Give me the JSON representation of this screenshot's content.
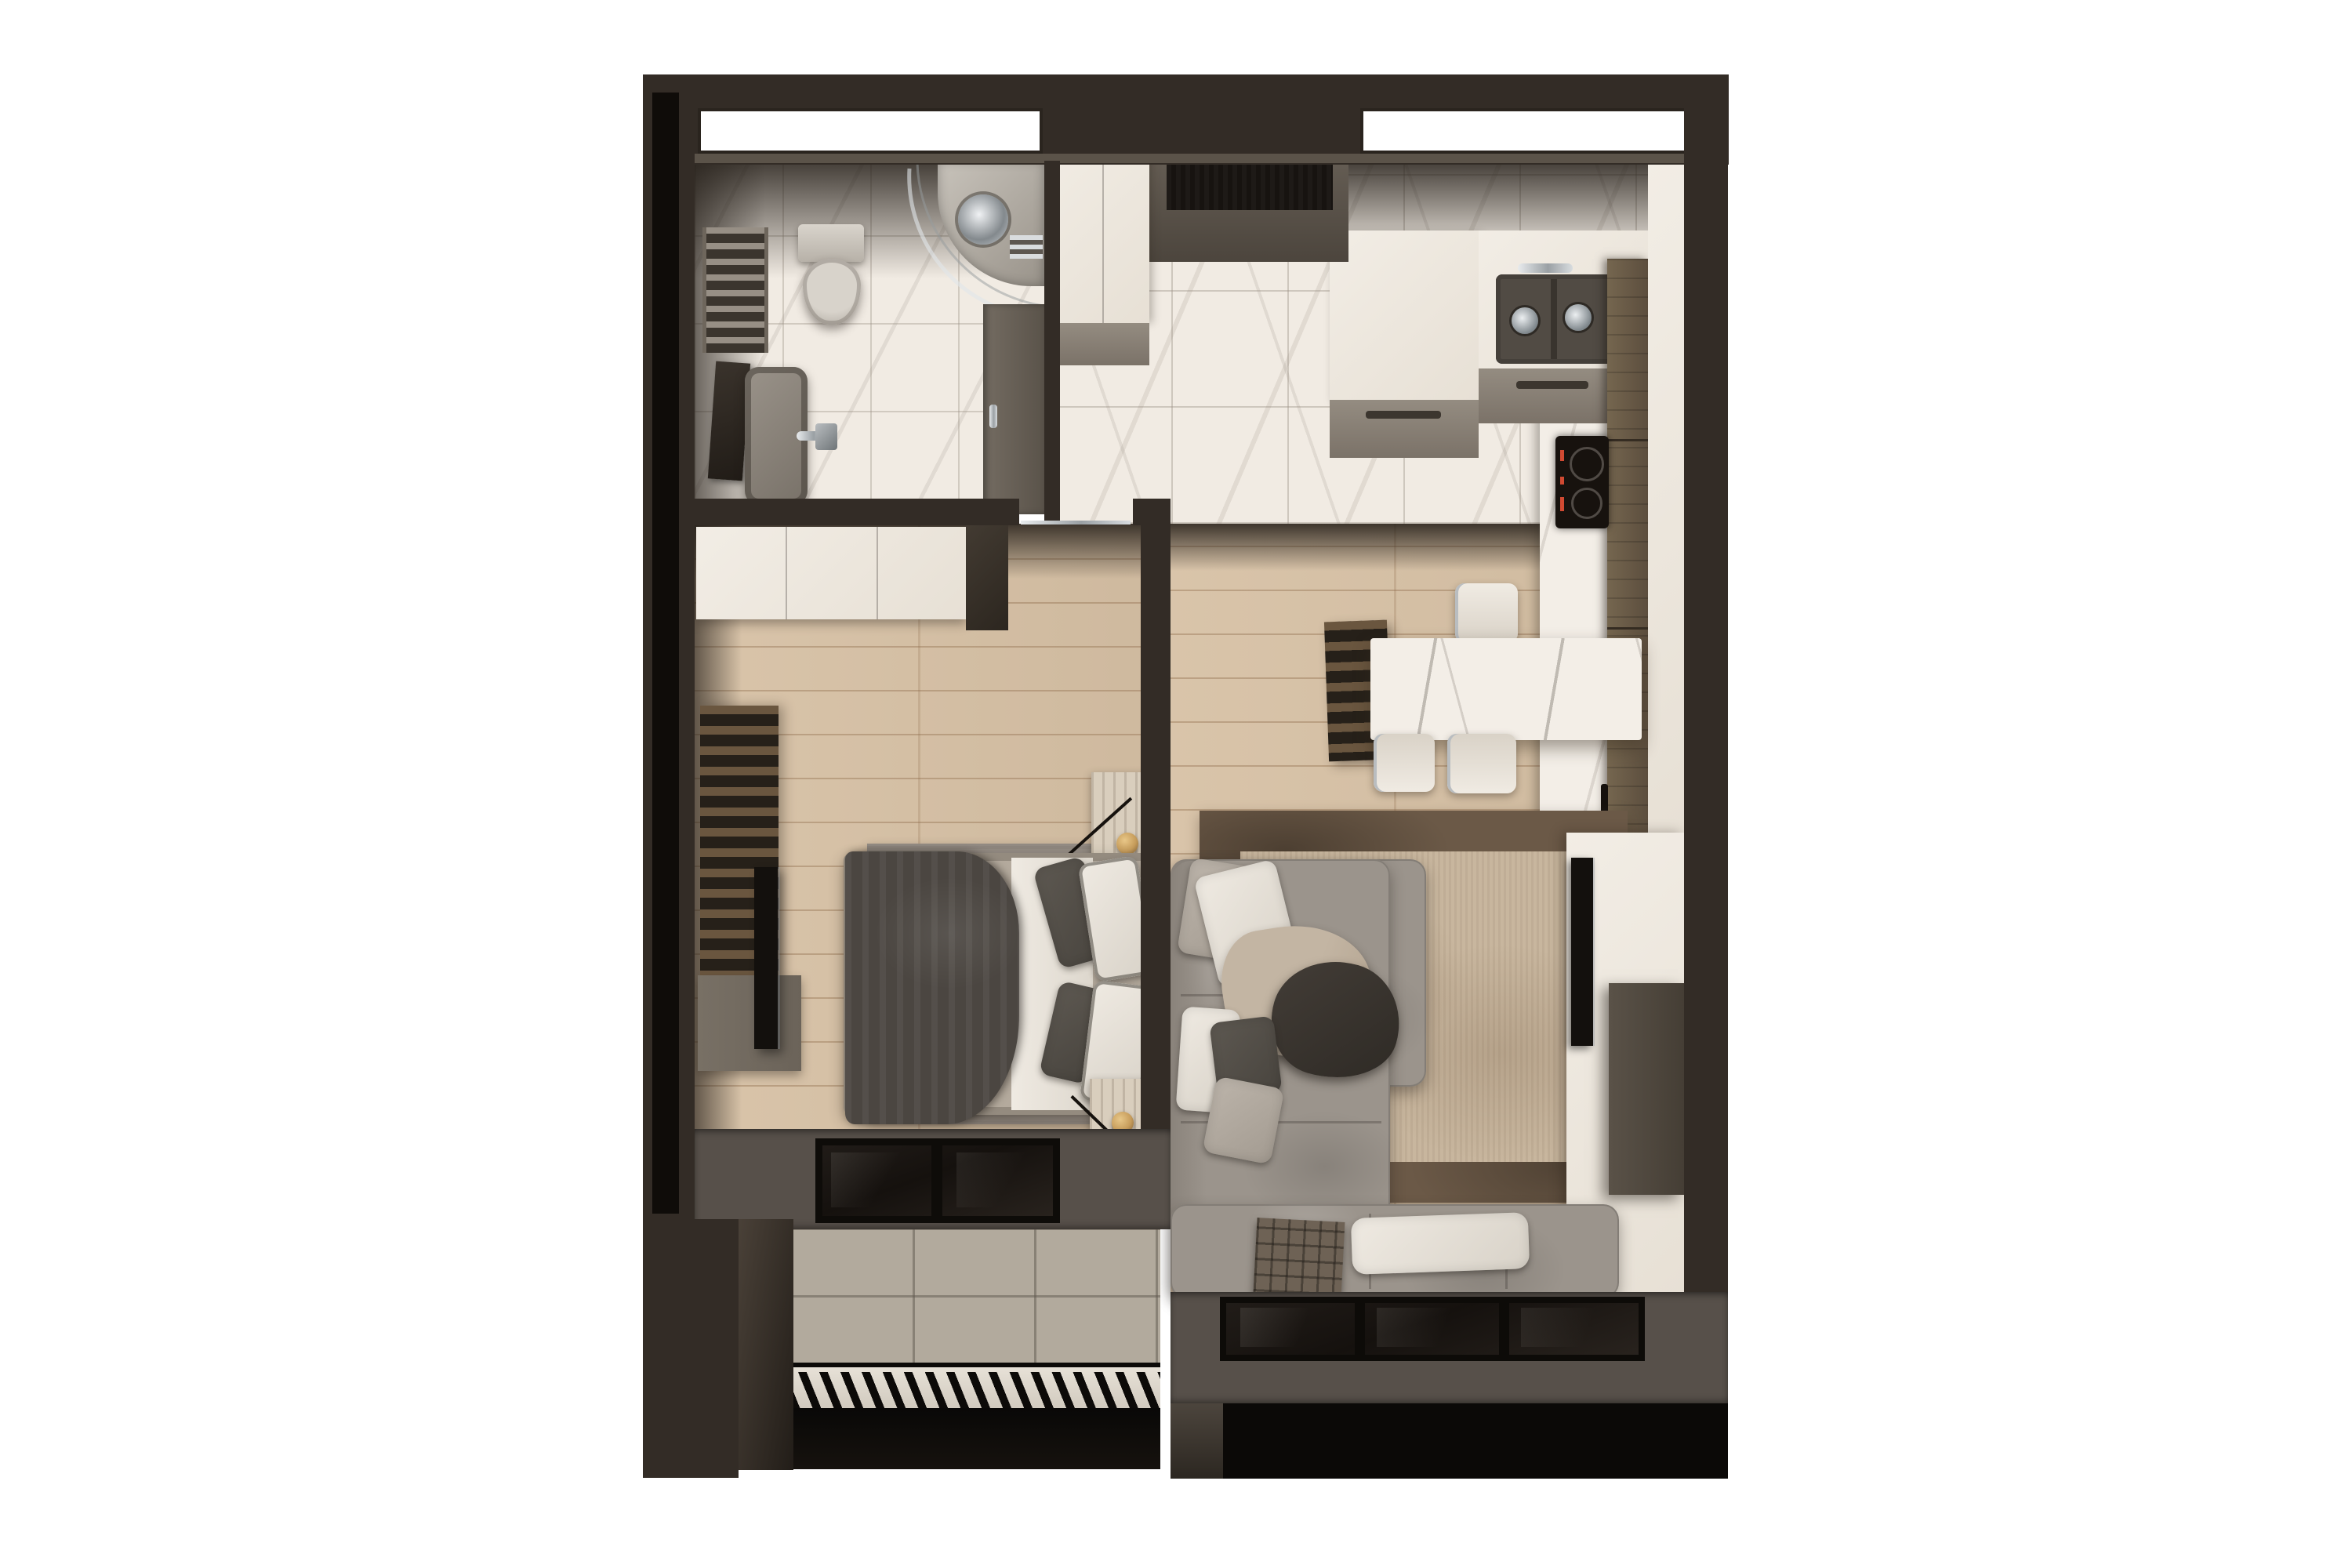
{
  "scene": {
    "kind": "3d-floor-plan-render",
    "view": "top-down",
    "apartment_type": "one-bedroom",
    "background": "#ffffff"
  },
  "palette": {
    "wall_dark": "#332c26",
    "wall_black": "#0f0c09",
    "wall_face": "#5b5349",
    "wall_band": "#57504a",
    "marble": "#f1ebe3",
    "counter": "#f3eee7",
    "wood": "#d7c1a5",
    "stone": "#b2aa9d",
    "glass_dark": "#1b1714",
    "chrome": "#c9cdd0",
    "white_furniture": "#eee8df",
    "grey_cabinet": "#8c847a",
    "wood_cabinet": "#695a49",
    "sofa": "#9b948c",
    "rug_living": "#c8b69e",
    "rug_living_border": "#6b5947",
    "rug_bedroom": "#948c84",
    "duvet": "#4b4641",
    "sheet": "#e9e4dc",
    "bed_frame": "#b4aa9d",
    "table_marble": "#f3eee7",
    "tv_black": "#13100d",
    "balcony_dark": "#0b0907",
    "hob_black": "#17120e",
    "hob_red": "#d14a32",
    "lamp_gold": "#c79d5c",
    "entry_door": "#171310",
    "nightstand": "#d9cebd"
  },
  "rooms": [
    {
      "id": "bathroom",
      "items": [
        "towel-radiator",
        "wall-hung-toilet",
        "corner-shower",
        "washbasin",
        "mirror",
        "pocket-door",
        "window"
      ]
    },
    {
      "id": "hallway",
      "items": [
        "entry-door",
        "closet"
      ]
    },
    {
      "id": "kitchen",
      "items": [
        "window",
        "double-sink",
        "faucet",
        "induction-hob",
        "tall-cabinets",
        "counter"
      ]
    },
    {
      "id": "dining",
      "items": [
        "marble-table",
        "slat-bench",
        "chair",
        "chair",
        "chair"
      ]
    },
    {
      "id": "bedroom",
      "items": [
        "wardrobe",
        "double-bed",
        "duvet",
        "pillows",
        "nightstand",
        "nightstand",
        "table-lamp",
        "table-lamp",
        "rug",
        "tv",
        "wood-slat-panel",
        "window"
      ]
    },
    {
      "id": "living-room",
      "items": [
        "corner-sofa",
        "pillows",
        "throw-blanket",
        "plaid-throw",
        "rug",
        "tv",
        "media-wall",
        "console",
        "window"
      ]
    },
    {
      "id": "balcony-bedroom",
      "items": [
        "stone-tile-floor",
        "railing"
      ]
    },
    {
      "id": "balcony-living",
      "items": []
    }
  ],
  "counts": {
    "dining_chairs": 3,
    "bedroom_window_panes": 2,
    "living_window_panes": 3,
    "kitchen_sink_bowls": 2,
    "hob_burners": 2
  }
}
